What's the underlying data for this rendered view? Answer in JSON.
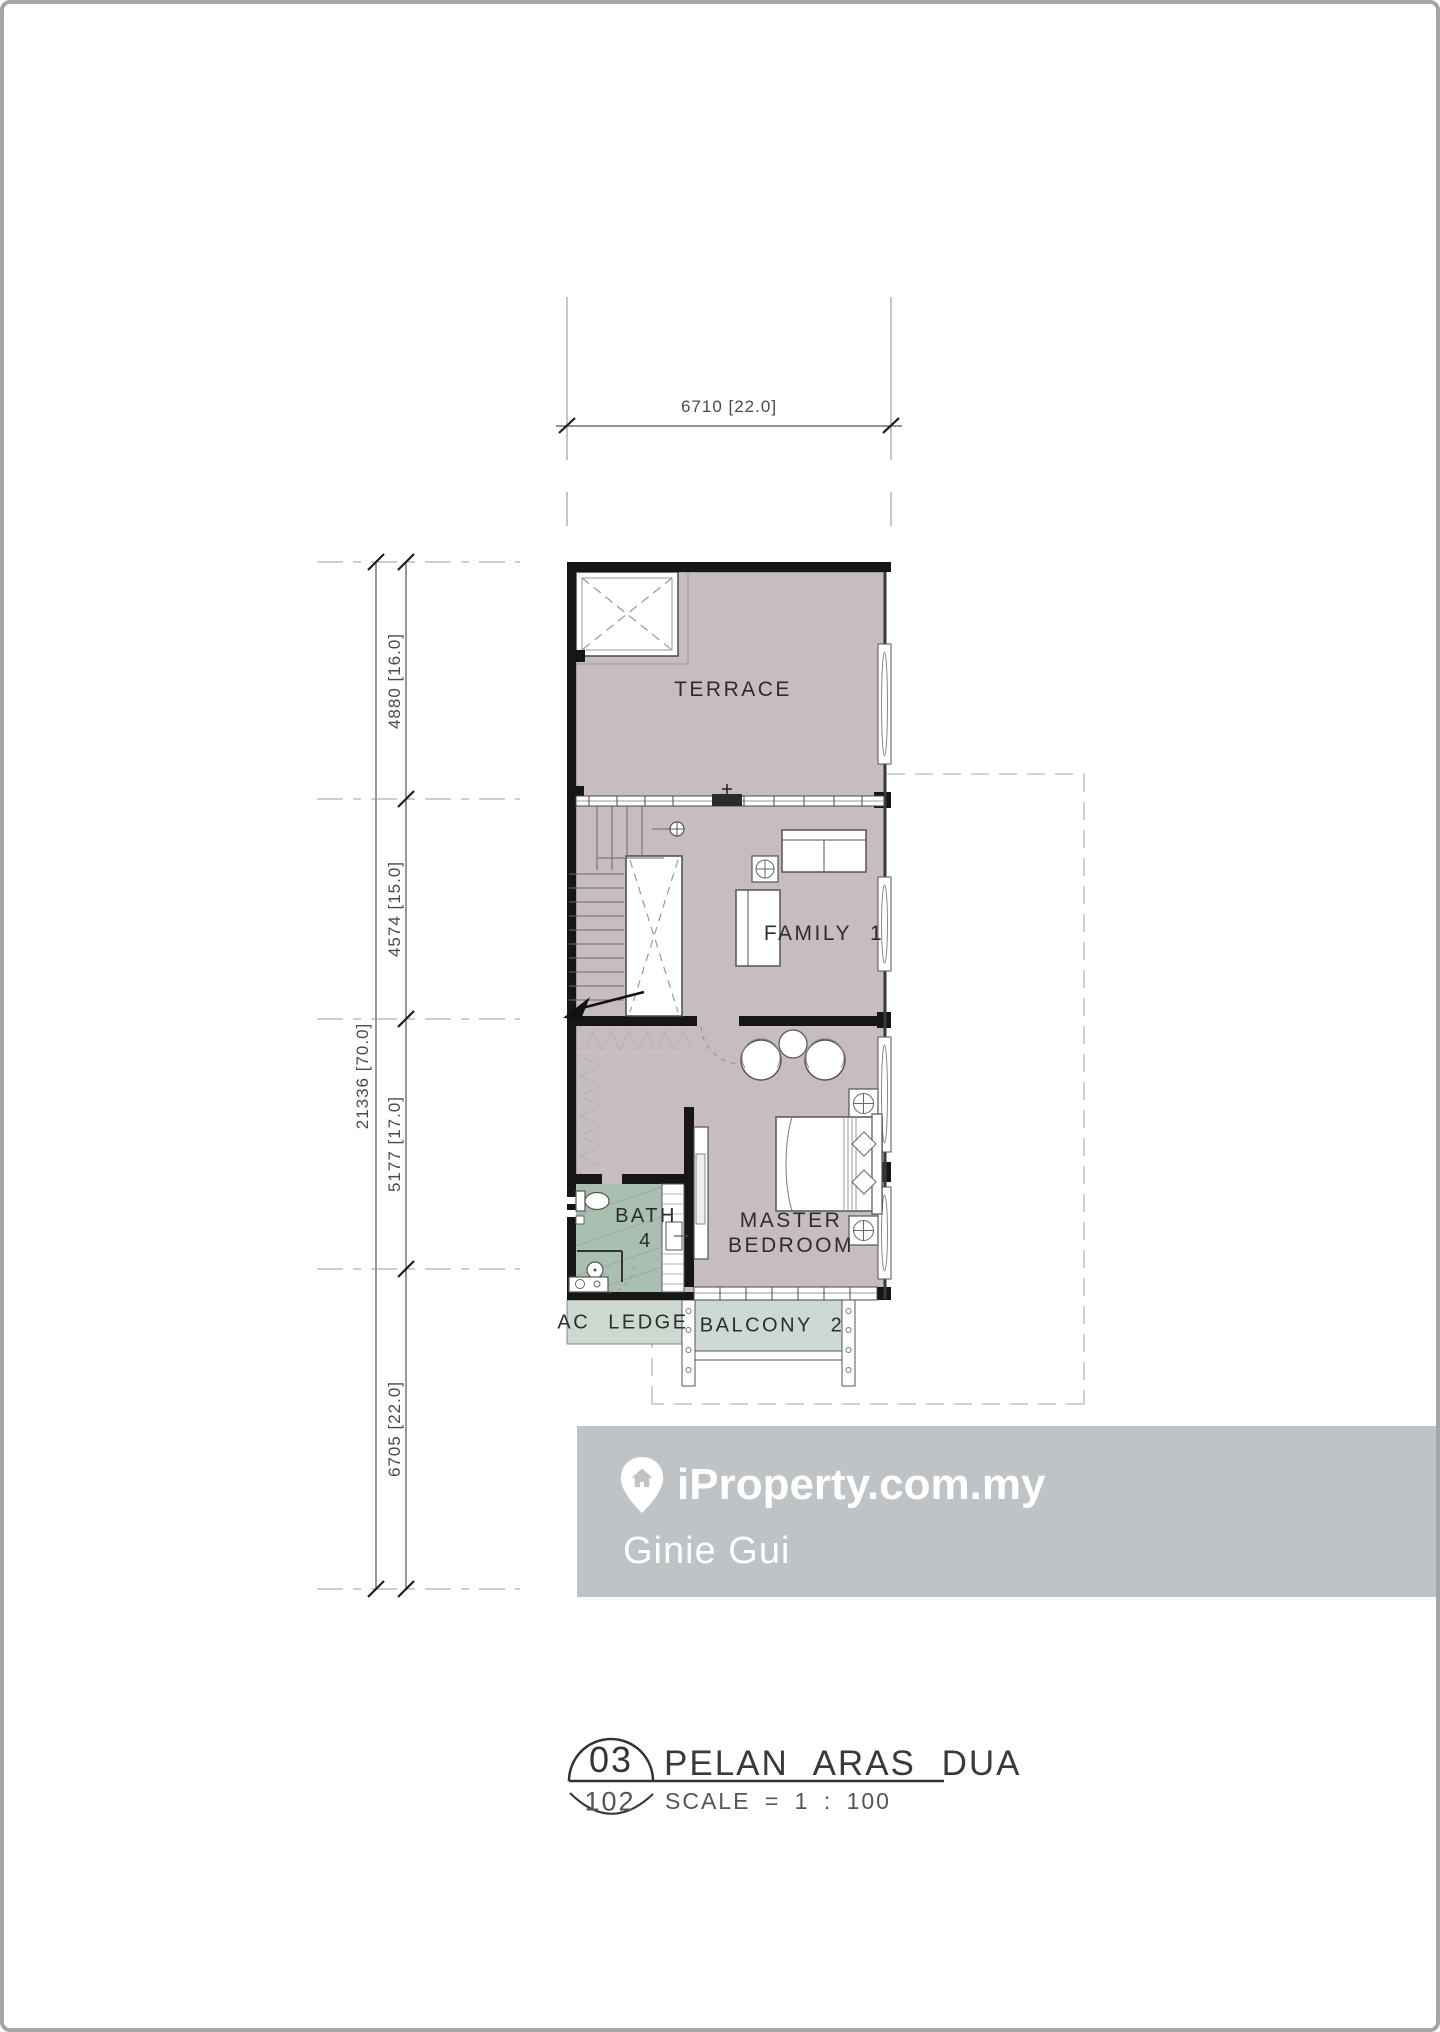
{
  "plan": {
    "rooms": {
      "terrace": "TERRACE",
      "family": "FAMILY 1",
      "master_line1": "MASTER",
      "master_line2": "BEDROOM",
      "bath_line1": "BATH",
      "bath_line2": "4",
      "ac_ledge": "AC LEDGE",
      "balcony": "BALCONY 2"
    },
    "colors": {
      "floor": "#c7bdbe",
      "bath_floor": "#a9bfb2",
      "ac_ledge_floor": "#ccd8d0",
      "balcony_floor": "#cdd9d6",
      "wall": "#161616"
    }
  },
  "dimensions": {
    "top_width": "6710 [22.0]",
    "overall_depth": "21336 [70.0]",
    "segments": [
      {
        "label": "4880 [16.0]"
      },
      {
        "label": "4574 [15.0]"
      },
      {
        "label": "5177 [17.0]"
      },
      {
        "label": "6705 [22.0]"
      }
    ]
  },
  "watermark": {
    "brand": "iProperty.com.my",
    "agent": "Ginie Gui",
    "background": "#c0c3c6"
  },
  "title_block": {
    "drawing_number": "03",
    "sheet_number": "102",
    "title": "PELAN ARAS DUA",
    "scale_note": "SCALE = 1 : 100"
  }
}
